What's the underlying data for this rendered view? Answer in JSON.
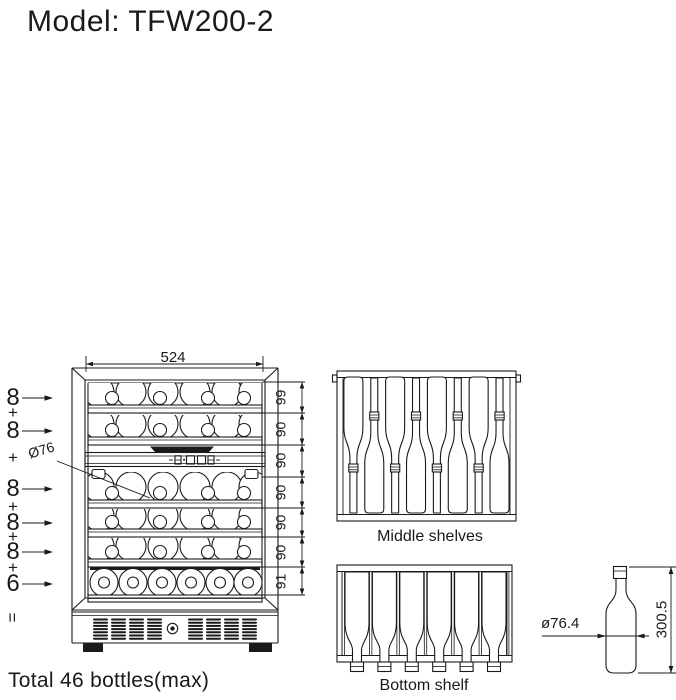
{
  "title": "Model: TFW200-2",
  "front_view": {
    "width_dim": "524",
    "height_dims": [
      "99",
      "90",
      "90",
      "90",
      "90",
      "90",
      "91"
    ],
    "bottle_dia_callout": "Ø76",
    "counts": {
      "rows": [
        "8",
        "8",
        "8",
        "8",
        "8",
        "6"
      ],
      "plus": "+",
      "equals": "="
    }
  },
  "middle_shelves": {
    "caption": "Middle shelves"
  },
  "bottom_shelf": {
    "caption": "Bottom shelf"
  },
  "bottle_detail": {
    "diameter": "ø76.4",
    "height": "300.5"
  },
  "footer": {
    "total": "Total 46 bottles(max)"
  },
  "colors": {
    "ink": "#1a1a1a",
    "paper": "#ffffff"
  }
}
